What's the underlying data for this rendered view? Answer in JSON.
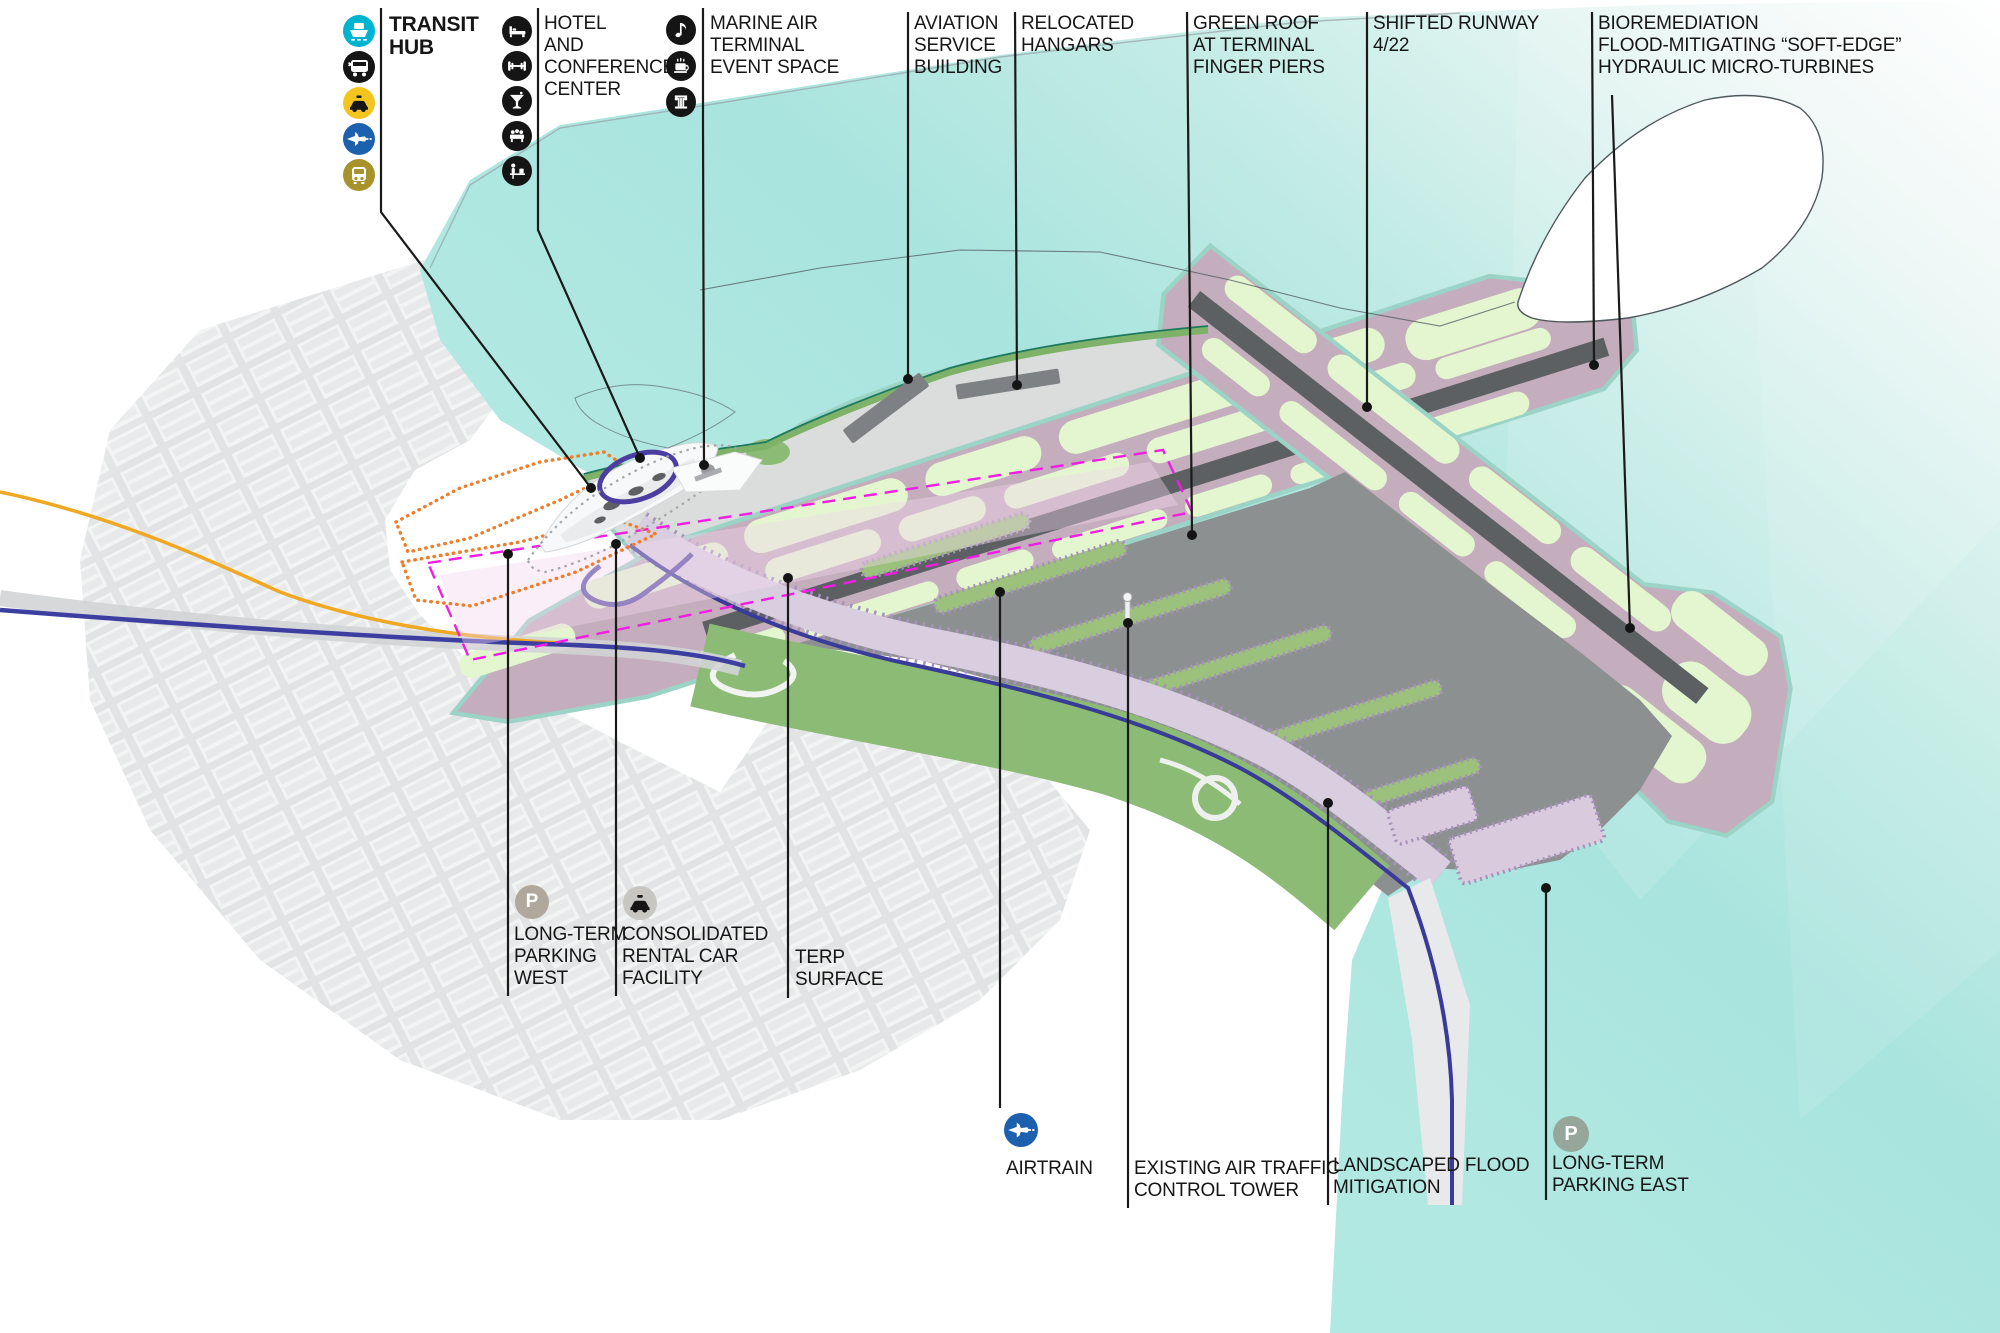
{
  "legend_groups": [
    {
      "id": "transit-hub",
      "title_lines": [
        "TRANSIT",
        "HUB"
      ],
      "icons": [
        "ferry-icon",
        "express-bus-icon",
        "taxi-icon",
        "airtrain-icon",
        "subway-icon"
      ]
    },
    {
      "id": "hotel-conference",
      "lines": [
        "HOTEL",
        "AND",
        "CONFERENCE",
        "CENTER"
      ],
      "icons": [
        "bed-icon",
        "gym-icon",
        "bar-icon",
        "banquet-icon",
        "workstation-icon"
      ]
    },
    {
      "id": "marine-air-terminal",
      "lines": [
        "MARINE AIR",
        "TERMINAL",
        "EVENT SPACE"
      ],
      "icons": [
        "music-icon",
        "cafe-icon",
        "museum-icon"
      ]
    }
  ],
  "callouts_top": [
    {
      "lines": [
        "AVIATION",
        "SERVICE",
        "BUILDING"
      ]
    },
    {
      "lines": [
        "RELOCATED",
        "HANGARS"
      ]
    },
    {
      "lines": [
        "GREEN ROOF",
        "AT TERMINAL",
        "FINGER PIERS"
      ]
    },
    {
      "lines": [
        "SHIFTED RUNWAY",
        "4/22"
      ]
    },
    {
      "lines": [
        "BIOREMEDIATION",
        "FLOOD-MITIGATING “SOFT-EDGE”",
        "HYDRAULIC MICRO-TURBINES"
      ]
    }
  ],
  "callouts_bottom": [
    {
      "lines": [
        "LONG-TERM",
        "PARKING",
        "WEST"
      ],
      "icon": "parking-icon",
      "icon_letter": "P"
    },
    {
      "lines": [
        "CONSOLIDATED",
        "RENTAL CAR",
        "FACILITY"
      ],
      "icon": "rental-car-icon"
    },
    {
      "lines": [
        "TERP",
        "SURFACE"
      ]
    },
    {
      "lines": [
        "AIRTRAIN"
      ],
      "icon": "airtrain-icon"
    },
    {
      "lines": [
        "EXISTING AIR TRAFFIC",
        "CONTROL TOWER"
      ]
    },
    {
      "lines": [
        "LANDSCAPED FLOOD",
        "MITIGATION"
      ]
    },
    {
      "lines": [
        "LONG-TERM",
        "PARKING EAST"
      ],
      "icon": "parking-icon",
      "icon_letter": "P"
    }
  ],
  "colors": {
    "water": "#a9e4de",
    "water_light": "#e8f6f4",
    "shoreline_dark": "#1d7a5e",
    "shoreline_soft_edge": "#9bd4c6",
    "shore_green_band": "#7eb268",
    "apron_gray": "#dbdcdc",
    "tarmac_mauve": "#c4adbc",
    "runway_gray": "#5c6063",
    "infield_green": "#e3f6cf",
    "terminal_apron_dark": "#8d9091",
    "landscape_green": "#8cbb76",
    "pier_green": "#9bc17d",
    "pier_edge_purple": "#a891bb",
    "terminal_band_lavender": "#d9cde0",
    "airtrain_line_blue": "#3c3f9f",
    "highway_orange": "#f0a722",
    "boundary_magenta": "#f21ce4",
    "parking_boundary_orange": "#ee7e2b",
    "leader_black": "#1a1a1a",
    "ferry_icon_bg": "#00b4d0",
    "taxi_icon_bg": "#f3c51e",
    "airtrain_icon_bg": "#1d61ae",
    "subway_icon_bg": "#a8922c",
    "black_icon_bg": "#151515",
    "parking_west_icon_bg": "#b0a89c",
    "parking_east_icon_bg": "#97a69b",
    "rental_icon_bg": "#c8c6c3"
  }
}
